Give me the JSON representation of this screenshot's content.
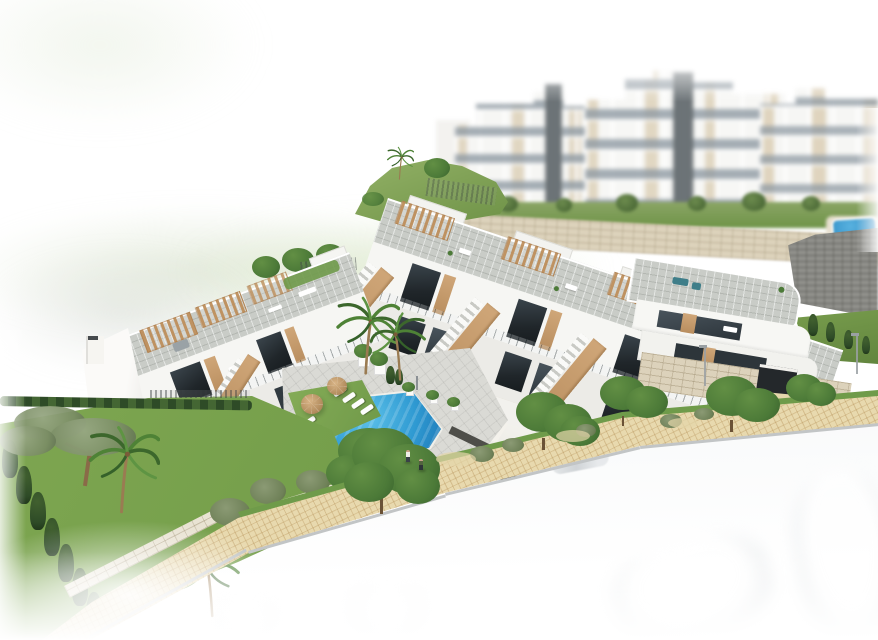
{
  "title": "Aerial 3D architectural rendering of a modern white residential complex on a hillside with communal pool",
  "palette": {
    "building_white": "#f6f6f3",
    "building_shade": "#ecebe7",
    "roof_gray": "#c9ccc7",
    "wood": "#c59a6a",
    "wood_dark": "#b98e5f",
    "window_dark": "#272d31",
    "glass_dark": "#39424a",
    "stone_beige": "#dcd2bb",
    "stone_line": "#a99872",
    "gray_wall": "#8f8f8a",
    "pool_light": "#5cc0e8",
    "pool_mid": "#2f9ad2",
    "pool_deep": "#1f7ab8",
    "grass_mat": "#7da653",
    "lawn_a": "#83aa54",
    "lawn_b": "#6f9a47",
    "hedge_dark": "#2e4b27",
    "tree_a": "#4c7a38",
    "tree_b": "#628f44",
    "tree_c": "#39622d",
    "walk_beige": "#e8d9ae",
    "walk_line": "#b28c52",
    "curb_gray": "#c2c5c6",
    "road_gray": "#e8ebed",
    "bg_tan": "#d2c09f",
    "bg_win": "#8d98a1",
    "tower_gray": "#575f63",
    "sand": "#e4d5aa",
    "trunk_brown": "#8a6a48",
    "umbrella_a": "#d9b587",
    "umbrella_b": "#96714a"
  },
  "scene": {
    "background": "blurred multi-storey white apartment blocks with beige panels and dark elevator towers, small pool on terraced stone walls",
    "midground": "row of modern white townhouses with roof solariums, wooden pergolas, wooden stair parapets and dark glazing above a beige stone podium wall",
    "left_building": "two-storey white apartment block with roof terrace, wooden pergolas, chimney gable and exterior stair",
    "corner_unit": "rounded corner townhouse with wrap-around terraces, rooftop lounge and garage driveway with gray car",
    "pool_area": {
      "pool": "blue communal swimming pool",
      "umbrellas": 2,
      "sun_loungers": 7,
      "people_on_path": 2
    },
    "landscape": {
      "palm_trees": 5,
      "lawn": "green garden with cypress hedge and umbrella pine",
      "hill": "grass slope with palm and fence",
      "street_trees": 5
    },
    "foreground": {
      "sidewalk": "curved beige paver path with grass verge",
      "road": "light road fading to white",
      "cars": [
        "faint silver car",
        "ghost outlines of parked cars"
      ]
    }
  }
}
